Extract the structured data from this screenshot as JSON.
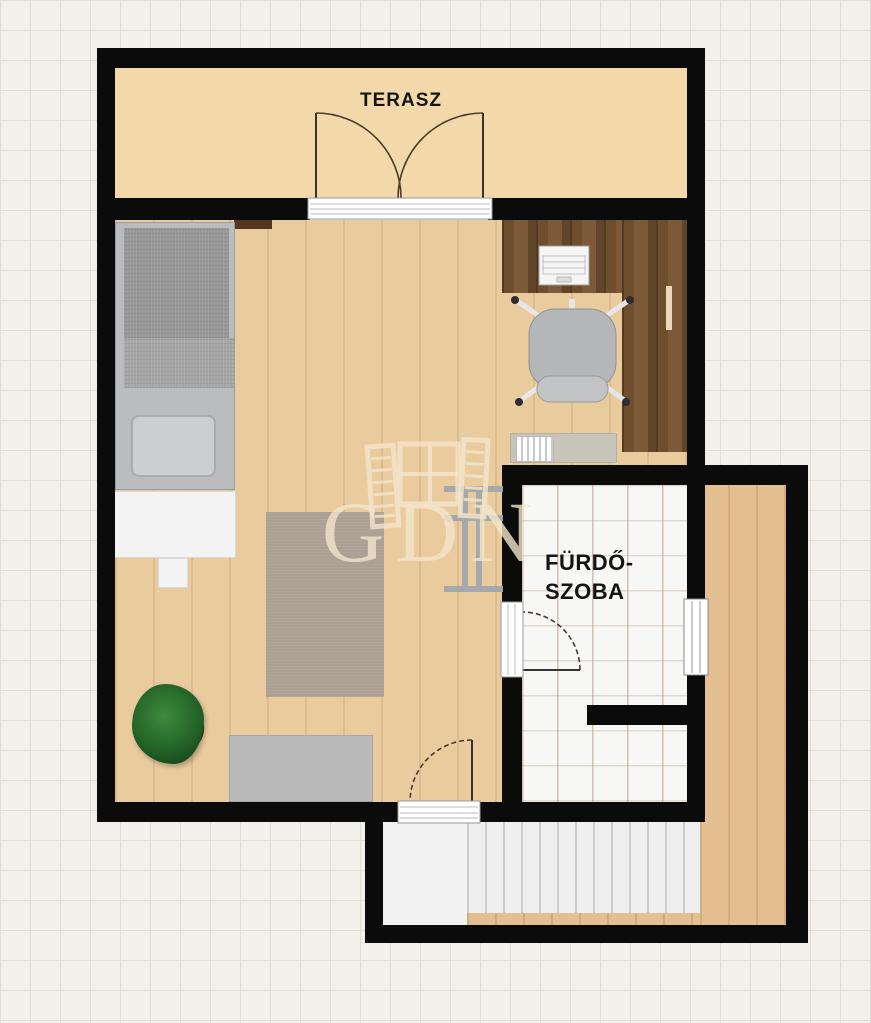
{
  "meta": {
    "type": "floor-plan",
    "language": "Hungarian",
    "watermark": "GDN"
  },
  "labels": {
    "terrace": "TERASZ",
    "bathroom": [
      "FÜRDŐ-",
      "SZOBA"
    ]
  },
  "rooms": [
    {
      "name": "TERASZ",
      "meaning": "terrace",
      "floor": "tile-beige"
    },
    {
      "name": "FÜRDŐSZOBA",
      "meaning": "bathroom",
      "floor": "white-tile"
    },
    {
      "name": "living-sleeping-room",
      "meaning": "main room (unlabeled)",
      "floor": "light-wood"
    },
    {
      "name": "corridor-stairwell",
      "meaning": "stair area (unlabeled)",
      "floor": "wood-with-stairs"
    }
  ],
  "furniture_icons": [
    "bed-icon",
    "pillow-icon",
    "bed-bench-icon",
    "desk-icon",
    "laptop-icon",
    "office-chair-icon",
    "wardrobe-handle-icon",
    "sideboard-icon",
    "shelf-rack-icon",
    "rug-icon",
    "potted-plant-icon",
    "cabinet-icon",
    "stairs-icon",
    "double-door-icon",
    "door-icon",
    "window-icon"
  ],
  "colors": {
    "wall": "#0b0b0b",
    "background": "#f2f0ea",
    "grid_line": "#e0ddd3",
    "terrace_floor": "#f3d9a9",
    "room_floor": "#e9cb9e",
    "desk_wood": "#6b4c30",
    "corridor_floor": "#e3bf92",
    "bathroom_tile": "#f7f7f6",
    "stair_tread": "#efefef",
    "rug": "#aca094",
    "plant_green": "#2e7d32",
    "watermark_cream": "#f4e6cb"
  }
}
